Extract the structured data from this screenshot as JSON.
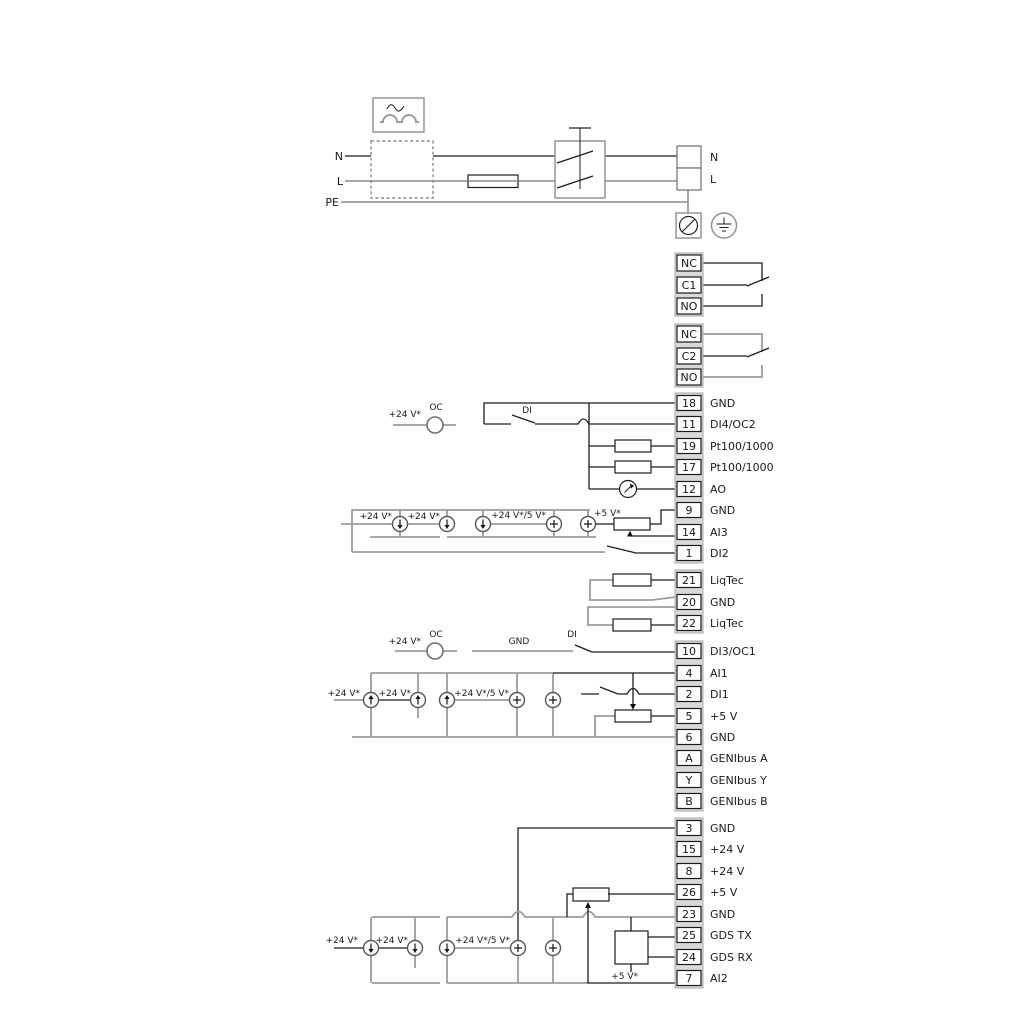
{
  "power": {
    "n": "N",
    "l": "L",
    "pe": "PE"
  },
  "power_out": {
    "items": [
      {
        "id": "",
        "label": "N"
      },
      {
        "id": "",
        "label": "L"
      }
    ]
  },
  "relay1": {
    "items": [
      {
        "id": "NC",
        "label": ""
      },
      {
        "id": "C1",
        "label": ""
      },
      {
        "id": "NO",
        "label": ""
      }
    ]
  },
  "relay2": {
    "items": [
      {
        "id": "NC",
        "label": ""
      },
      {
        "id": "C2",
        "label": ""
      },
      {
        "id": "NO",
        "label": ""
      }
    ]
  },
  "io1": {
    "items": [
      {
        "id": "18",
        "label": "GND"
      },
      {
        "id": "11",
        "label": "DI4/OC2"
      },
      {
        "id": "19",
        "label": "Pt100/1000"
      },
      {
        "id": "17",
        "label": "Pt100/1000"
      },
      {
        "id": "12",
        "label": "AO"
      },
      {
        "id": "9",
        "label": "GND"
      },
      {
        "id": "14",
        "label": "AI3"
      },
      {
        "id": "1",
        "label": "DI2"
      }
    ]
  },
  "liqtec": {
    "items": [
      {
        "id": "21",
        "label": "LiqTec"
      },
      {
        "id": "20",
        "label": "GND"
      },
      {
        "id": "22",
        "label": "LiqTec"
      }
    ]
  },
  "io2": {
    "items": [
      {
        "id": "10",
        "label": "DI3/OC1"
      },
      {
        "id": "4",
        "label": "AI1"
      },
      {
        "id": "2",
        "label": "DI1"
      },
      {
        "id": "5",
        "label": "+5 V"
      },
      {
        "id": "6",
        "label": "GND"
      },
      {
        "id": "A",
        "label": "GENIbus A"
      },
      {
        "id": "Y",
        "label": "GENIbus Y"
      },
      {
        "id": "B",
        "label": "GENIbus B"
      }
    ]
  },
  "io3": {
    "items": [
      {
        "id": "3",
        "label": "GND"
      },
      {
        "id": "15",
        "label": "+24 V"
      },
      {
        "id": "8",
        "label": "+24 V"
      },
      {
        "id": "26",
        "label": "+5 V"
      },
      {
        "id": "23",
        "label": "GND"
      },
      {
        "id": "25",
        "label": "GDS TX"
      },
      {
        "id": "24",
        "label": "GDS RX"
      },
      {
        "id": "7",
        "label": "AI2"
      }
    ]
  },
  "annotations": {
    "di4": {
      "supply": "+24 V*",
      "oc": "OC",
      "di": "DI"
    },
    "ai3": {
      "s1": "+24 V*",
      "s2": "+24 V*",
      "s3": "+24 V*/5 V*",
      "s4": "+5 V*"
    },
    "di3": {
      "supply": "+24 V*",
      "oc": "OC",
      "gnd": "GND",
      "di": "DI"
    },
    "ai1": {
      "s1": "+24 V*",
      "s2": "+24 V*",
      "s3": "+24 V*/5 V*"
    },
    "ai2": {
      "s1": "+24 V*",
      "s2": "+24 V*",
      "s3": "+24 V*/5 V*",
      "gds": "+5 V*"
    }
  },
  "colors": {
    "wire_dark": "#1c1c1c",
    "wire_gray": "#9c9c9c",
    "strip": "#d9d9d9"
  }
}
